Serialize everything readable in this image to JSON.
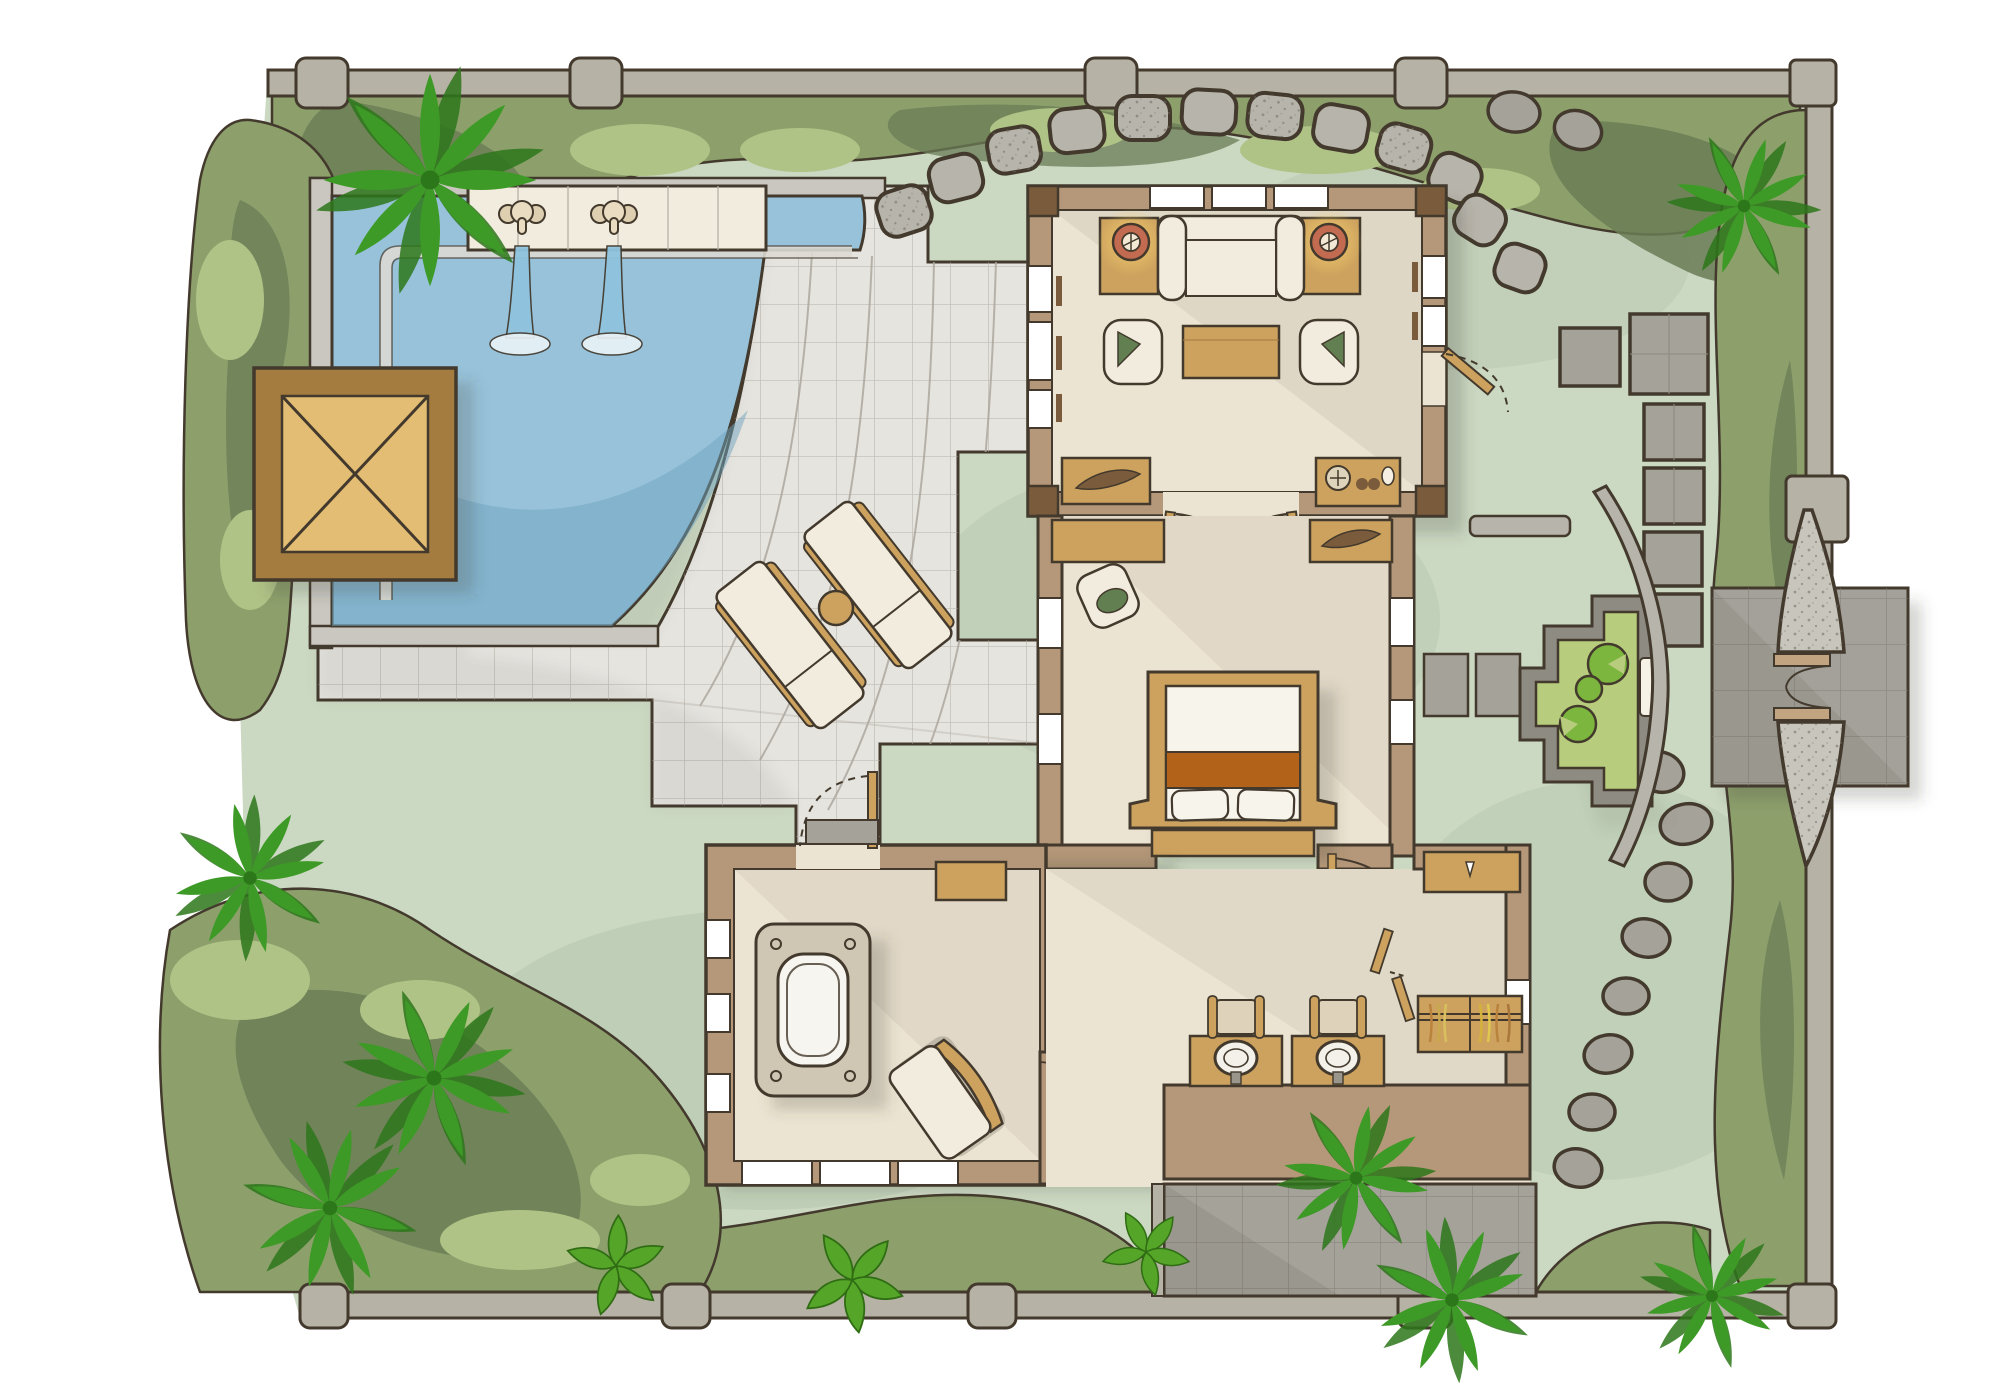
{
  "palette": {
    "lawn": "#cbd8c2",
    "lawn_shade": "#b7c8af",
    "hedge_mid": "#8da06c",
    "hedge_light": "#b0c386",
    "hedge_dark": "#6a7c55",
    "palm": "#3e9a27",
    "palm_dark": "#2d771b",
    "leaf": "#55a528",
    "water": "#97c2da",
    "water_deep": "#6fa3bf",
    "pool_curb": "#c9c7c0",
    "tile": "#e6e4df",
    "tile_line": "#9a958c",
    "wood": "#cda25e",
    "wood_dark": "#a47c3f",
    "wood_light": "#e3bd74",
    "wall_tan": "#b59879",
    "wall_dark": "#7a5c3c",
    "floor_cream": "#ece4d2",
    "cream": "#f2ecdf",
    "gray_stone": "#b7b4ab",
    "gray_paver": "#a5a29a",
    "gray_dark": "#8e8b83",
    "boundary": "#b6b2a5",
    "pond": "#b7cc7d",
    "lily": "#7cb63e",
    "orange_runner": "#b26219",
    "lamp_ring": "#c26b50",
    "lamp_glow": "#f7d26f",
    "accent_green": "#617f50",
    "outline": "#433a2d",
    "shadow": "rgba(70,64,52,0.22)"
  },
  "plan": {
    "type": "resort-villa-floor-plan",
    "rooms": [
      {
        "name": "living-pavilion",
        "furniture": [
          "sofa",
          "side-table-with-lamp",
          "side-table-with-lamp",
          "coffee-table",
          "armchair",
          "armchair",
          "writing-desk",
          "media-console",
          "french-doors"
        ]
      },
      {
        "name": "bedroom",
        "furniture": [
          "double-bed",
          "bed-bench",
          "desk",
          "desk-chair",
          "console-desk"
        ]
      },
      {
        "name": "bathroom",
        "furniture": [
          "bathtub-on-platform",
          "wood-bench",
          "lounge-chair",
          "toilet"
        ]
      },
      {
        "name": "dressing-room",
        "furniture": [
          "vanity-sink",
          "vanity-sink",
          "stool",
          "stool",
          "wardrobe",
          "console"
        ]
      }
    ],
    "outdoor_features": [
      "swimming-pool",
      "elephant-fountain",
      "elephant-fountain",
      "pool-pavilion-deck",
      "sun-lounger",
      "sun-lounger",
      "round-side-table",
      "curved-tile-terrace",
      "stepping-stone-path",
      "square-paver-path",
      "lily-pond",
      "stone-bench",
      "curved-garden-wall",
      "entrance-gate",
      "entry-court",
      "outdoor-shower-court",
      "boundary-wall",
      "hedges",
      "palm-trees"
    ],
    "counts": {
      "living_room_top_windows": 3,
      "fountain_spouts": 2,
      "sun_loungers": 2,
      "vanity_sinks": 2,
      "lily_pads": 3,
      "gate_pillars": 2
    }
  }
}
